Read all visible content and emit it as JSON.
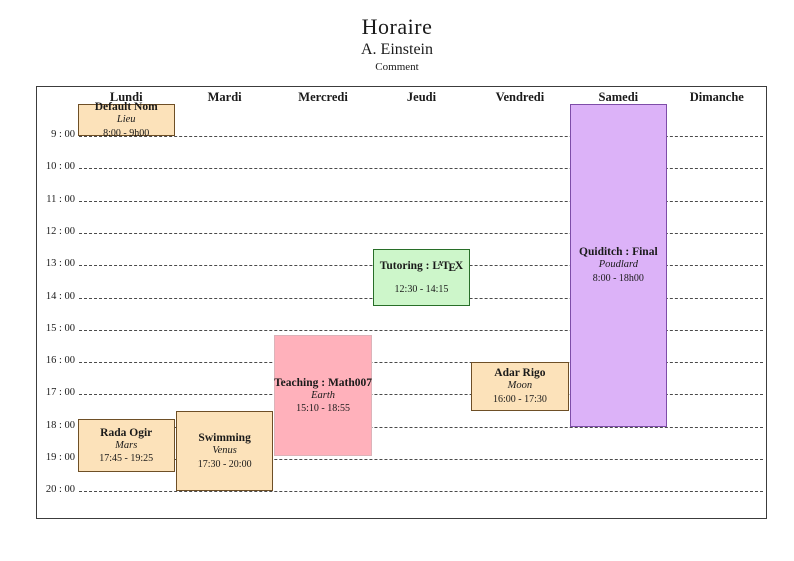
{
  "page": {
    "title": "Horaire",
    "subtitle": "A. Einstein",
    "comment": "Comment"
  },
  "schedule": {
    "days": [
      "Lundi",
      "Mardi",
      "Mercredi",
      "Jeudi",
      "Vendredi",
      "Samedi",
      "Dimanche"
    ],
    "time_labels": [
      "9 : 00",
      "10 : 00",
      "11 : 00",
      "12 : 00",
      "13 : 00",
      "14 : 00",
      "15 : 00",
      "16 : 00",
      "17 : 00",
      "18 : 00",
      "19 : 00",
      "20 : 00"
    ],
    "first_labeled_hour": 9,
    "last_labeled_hour": 20,
    "colors": {
      "orange": {
        "fill": "#FCE2BA",
        "border": "#6E4F26"
      },
      "red": {
        "fill": "#FFB1BB",
        "border": "#DCB3B9"
      },
      "green": {
        "fill": "#CDF6CA",
        "border": "#286E28"
      },
      "violet": {
        "fill": "#DCB2F8",
        "border": "#7E4DA8"
      }
    },
    "events": [
      {
        "name": "default-nom",
        "day": 0,
        "start": 8.0,
        "end": 9.0,
        "title": "Default Nom",
        "venue": "Lieu",
        "time": "8:00 - 9h00",
        "color": "orange"
      },
      {
        "name": "rada-ogir",
        "day": 0,
        "start": 17.75,
        "end": 19.4167,
        "title": "Rada Ogir",
        "venue": "Mars",
        "time": "17:45 - 19:25",
        "color": "orange"
      },
      {
        "name": "swimming",
        "day": 1,
        "start": 17.5,
        "end": 20.0,
        "title": "Swimming",
        "venue": "Venus",
        "time": "17:30 - 20:00",
        "color": "orange"
      },
      {
        "name": "teaching-math007",
        "day": 2,
        "start": 15.1667,
        "end": 18.9167,
        "title": "Teaching : Math007",
        "venue": "Earth",
        "time": "15:10 - 18:55",
        "color": "red"
      },
      {
        "name": "tutoring-latex",
        "day": 3,
        "start": 12.5,
        "end": 14.25,
        "title": "Tutoring : LaTeX",
        "title_prefix": "Tutoring : ",
        "latex_logo": [
          "L",
          "A",
          "T",
          "E",
          "X"
        ],
        "venue": "",
        "time": "12:30 - 14:15",
        "color": "green"
      },
      {
        "name": "adar-rigo",
        "day": 4,
        "start": 16.0,
        "end": 17.5,
        "title": "Adar Rigo",
        "venue": "Moon",
        "time": "16:00 - 17:30",
        "color": "orange"
      },
      {
        "name": "quiditch-final",
        "day": 5,
        "start": 8.0,
        "end": 18.0,
        "title": "Quiditch : Final",
        "venue": "Poudlard",
        "time": "8:00 - 18h00",
        "color": "violet"
      }
    ]
  }
}
